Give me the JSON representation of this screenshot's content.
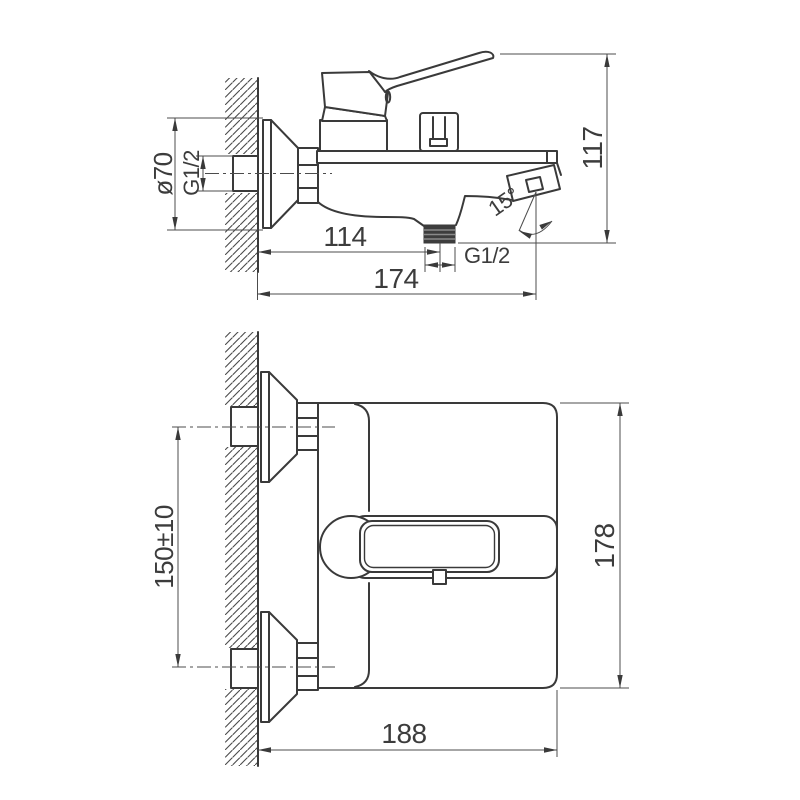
{
  "drawing": {
    "background": "#ffffff",
    "line_color": "#3a3a3a"
  },
  "dimensions": {
    "side": {
      "flange_diameter": "ø70",
      "wall_thread": "G1/2",
      "overall_height": "117",
      "wall_to_outlet": "114",
      "outlet_thread": "G1/2",
      "overall_projection": "174",
      "spout_angle": "15°"
    },
    "plan": {
      "connection_spacing": "150±10",
      "body_length": "178",
      "overall_depth": "188"
    }
  }
}
